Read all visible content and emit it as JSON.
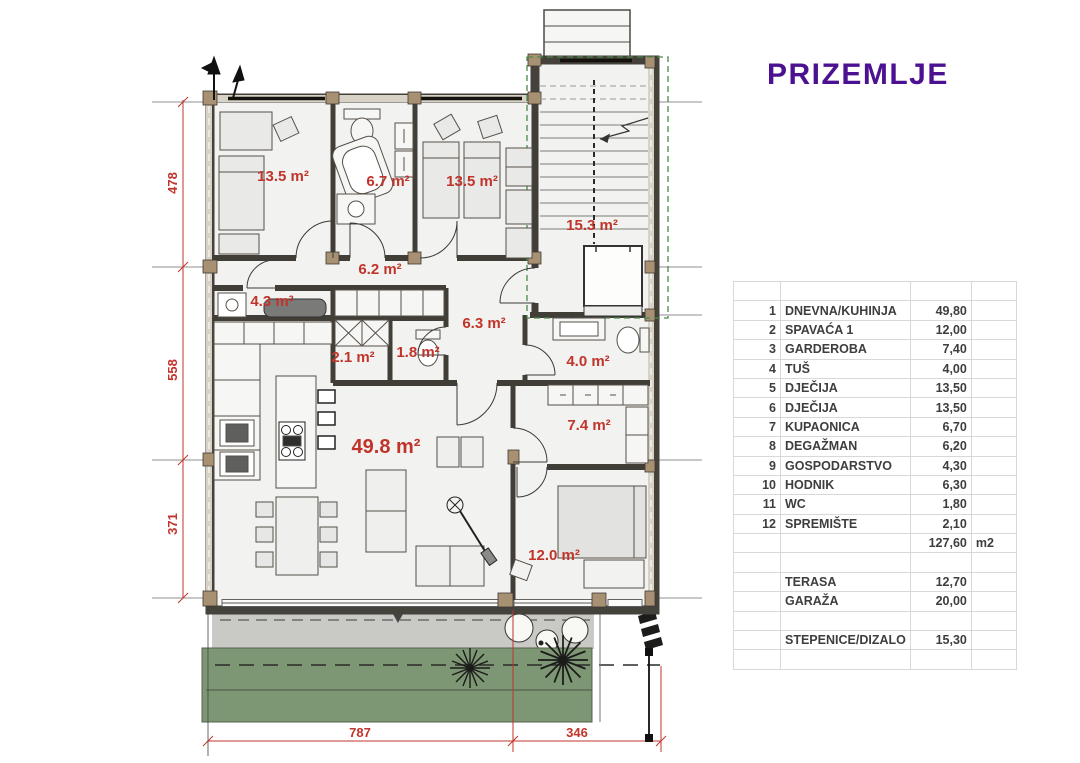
{
  "title": "PRIZEMLJE",
  "colors": {
    "accent_red": "#c0342b",
    "title_purple": "#4b1191",
    "garden_green": "#7d9673"
  },
  "plan": {
    "rooms": [
      {
        "name": "djecija-1",
        "label": "13.5 m²"
      },
      {
        "name": "kupaonica",
        "label": "6.7 m²"
      },
      {
        "name": "djecija-2",
        "label": "13.5 m²"
      },
      {
        "name": "stepenice-dizalo",
        "label": "15.3 m²"
      },
      {
        "name": "degazman",
        "label": "6.2 m²"
      },
      {
        "name": "gospodarstvo",
        "label": "4.3 m²"
      },
      {
        "name": "hodnik",
        "label": "6.3 m²"
      },
      {
        "name": "spremiste",
        "label": "2.1 m²"
      },
      {
        "name": "wc",
        "label": "1.8 m²"
      },
      {
        "name": "tus",
        "label": "4.0 m²"
      },
      {
        "name": "dnevna-kuhinja",
        "label": "49.8 m²"
      },
      {
        "name": "garderoba",
        "label": "7.4 m²"
      },
      {
        "name": "spavaca",
        "label": "12.0 m²"
      }
    ],
    "dimensions": {
      "left": [
        "478",
        "558",
        "371"
      ],
      "bottom": [
        "787",
        "346"
      ]
    }
  },
  "table": {
    "rows": [
      {
        "num": "",
        "name": "",
        "value": "",
        "unit": ""
      },
      {
        "num": "1",
        "name": "DNEVNA/KUHINJA",
        "value": "49,80",
        "unit": ""
      },
      {
        "num": "2",
        "name": "SPAVAĆA 1",
        "value": "12,00",
        "unit": ""
      },
      {
        "num": "3",
        "name": "GARDEROBA",
        "value": "7,40",
        "unit": ""
      },
      {
        "num": "4",
        "name": "TUŠ",
        "value": "4,00",
        "unit": ""
      },
      {
        "num": "5",
        "name": "DJEČIJA",
        "value": "13,50",
        "unit": ""
      },
      {
        "num": "6",
        "name": "DJEČIJA",
        "value": "13,50",
        "unit": ""
      },
      {
        "num": "7",
        "name": "KUPAONICA",
        "value": "6,70",
        "unit": ""
      },
      {
        "num": "8",
        "name": "DEGAŽMAN",
        "value": "6,20",
        "unit": ""
      },
      {
        "num": "9",
        "name": "GOSPODARSTVO",
        "value": "4,30",
        "unit": ""
      },
      {
        "num": "10",
        "name": "HODNIK",
        "value": "6,30",
        "unit": ""
      },
      {
        "num": "11",
        "name": "WC",
        "value": "1,80",
        "unit": ""
      },
      {
        "num": "12",
        "name": "SPREMIŠTE",
        "value": "2,10",
        "unit": ""
      },
      {
        "num": "",
        "name": "",
        "value": "127,60",
        "unit": "m2"
      },
      {
        "num": "",
        "name": "",
        "value": "",
        "unit": ""
      },
      {
        "num": "",
        "name": "TERASA",
        "value": "12,70",
        "unit": ""
      },
      {
        "num": "",
        "name": "GARAŽA",
        "value": "20,00",
        "unit": ""
      },
      {
        "num": "",
        "name": "",
        "value": "",
        "unit": ""
      },
      {
        "num": "",
        "name": "STEPENICE/DIZALO",
        "value": "15,30",
        "unit": ""
      },
      {
        "num": "",
        "name": "",
        "value": "",
        "unit": ""
      }
    ]
  }
}
